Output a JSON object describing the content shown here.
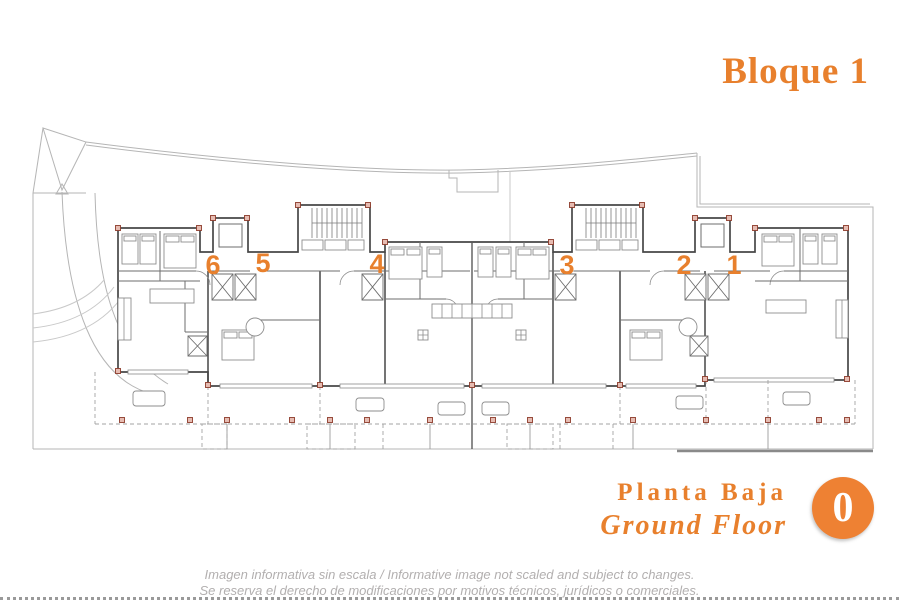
{
  "title": "Bloque 1",
  "plan": {
    "unit_labels": [
      "6",
      "5",
      "4",
      "3",
      "2",
      "1"
    ]
  },
  "floor": {
    "name_es": "Planta Baja",
    "name_en": "Ground Floor",
    "level_badge": "0"
  },
  "disclaimer": {
    "line1": "Imagen informativa sin escala /  Informative image not scaled and subject to changes.",
    "line2": "Se reserva el derecho de modificaciones por motivos técnicos, jurídicos o comerciales."
  },
  "colors": {
    "accent_orange": "#e8802d",
    "badge_orange": "#ee8133",
    "wall_gray": "#474747",
    "site_gray": "#b5b5b5",
    "dashed_gray": "#a3a3a3",
    "furniture_gray": "#8d8d8d",
    "pillar_fill": "#e6bcb2",
    "pillar_stroke": "#8d3b2b",
    "disclaimer_gray": "#b2afaf"
  }
}
